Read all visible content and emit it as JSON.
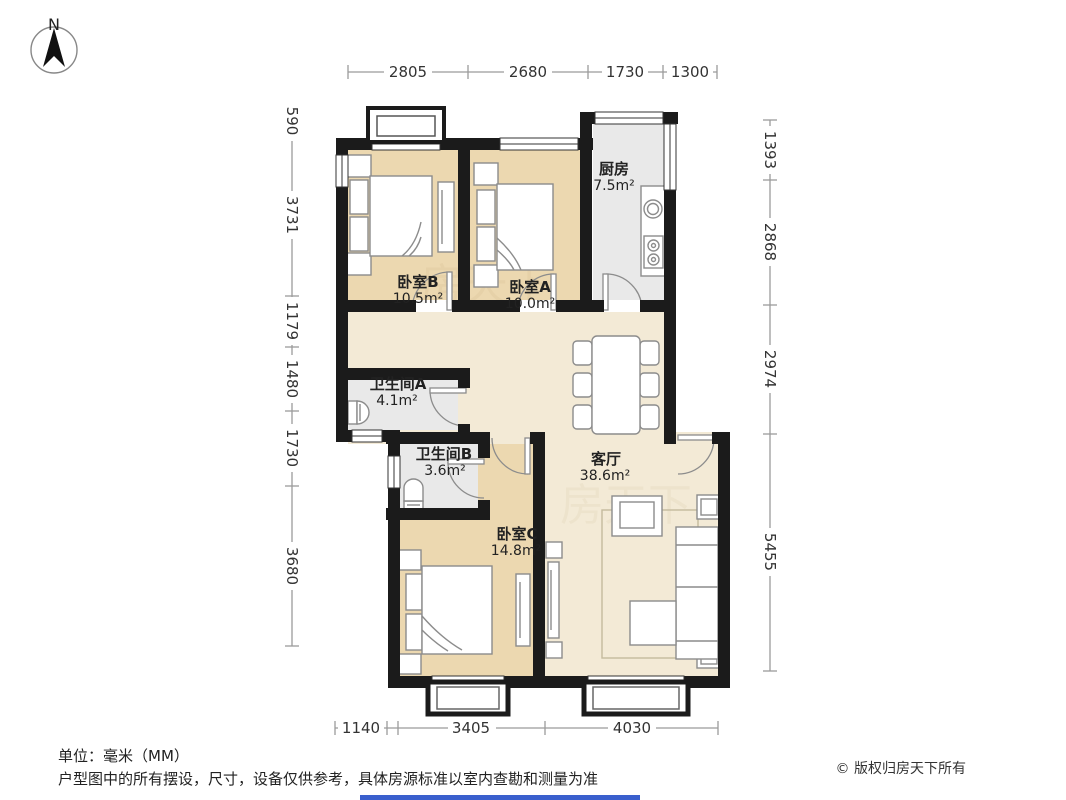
{
  "compass": {
    "label": "N"
  },
  "rooms": {
    "bedroomB": {
      "name": "卧室B",
      "area": "10.5m²"
    },
    "bedroomA": {
      "name": "卧室A",
      "area": "10.0m²"
    },
    "kitchen": {
      "name": "厨房",
      "area": "7.5m²"
    },
    "bathroomA": {
      "name": "卫生间A",
      "area": "4.1m²"
    },
    "bathroomB": {
      "name": "卫生间B",
      "area": "3.6m²"
    },
    "bedroomC": {
      "name": "卧室C",
      "area": "14.8m²"
    },
    "livingRoom": {
      "name": "客厅",
      "area": "38.6m²"
    }
  },
  "dimensions": {
    "top": [
      "2805",
      "2680",
      "1730",
      "1300"
    ],
    "left": [
      "590",
      "3731",
      "1179",
      "1480",
      "1730",
      "3680"
    ],
    "right": [
      "1393",
      "2868",
      "2974",
      "5455"
    ],
    "bottom": [
      "1140",
      "3405",
      "4030"
    ]
  },
  "footer": {
    "unit": "单位：毫米（MM）",
    "disclaimer": "户型图中的所有摆设，尺寸，设备仅供参考，具体房源标准以室内查勘和测量为准",
    "copyright": "© 版权归房天下所有"
  },
  "watermark": "房天下",
  "colors": {
    "wall": "#1b1b1b",
    "bedroomFloor": "#ecd8b0",
    "publicFloor": "#f3ead6",
    "wetFloor": "#e9e9e9",
    "dimLine": "#9b9b9b",
    "accentBar": "#3a5fcd"
  }
}
